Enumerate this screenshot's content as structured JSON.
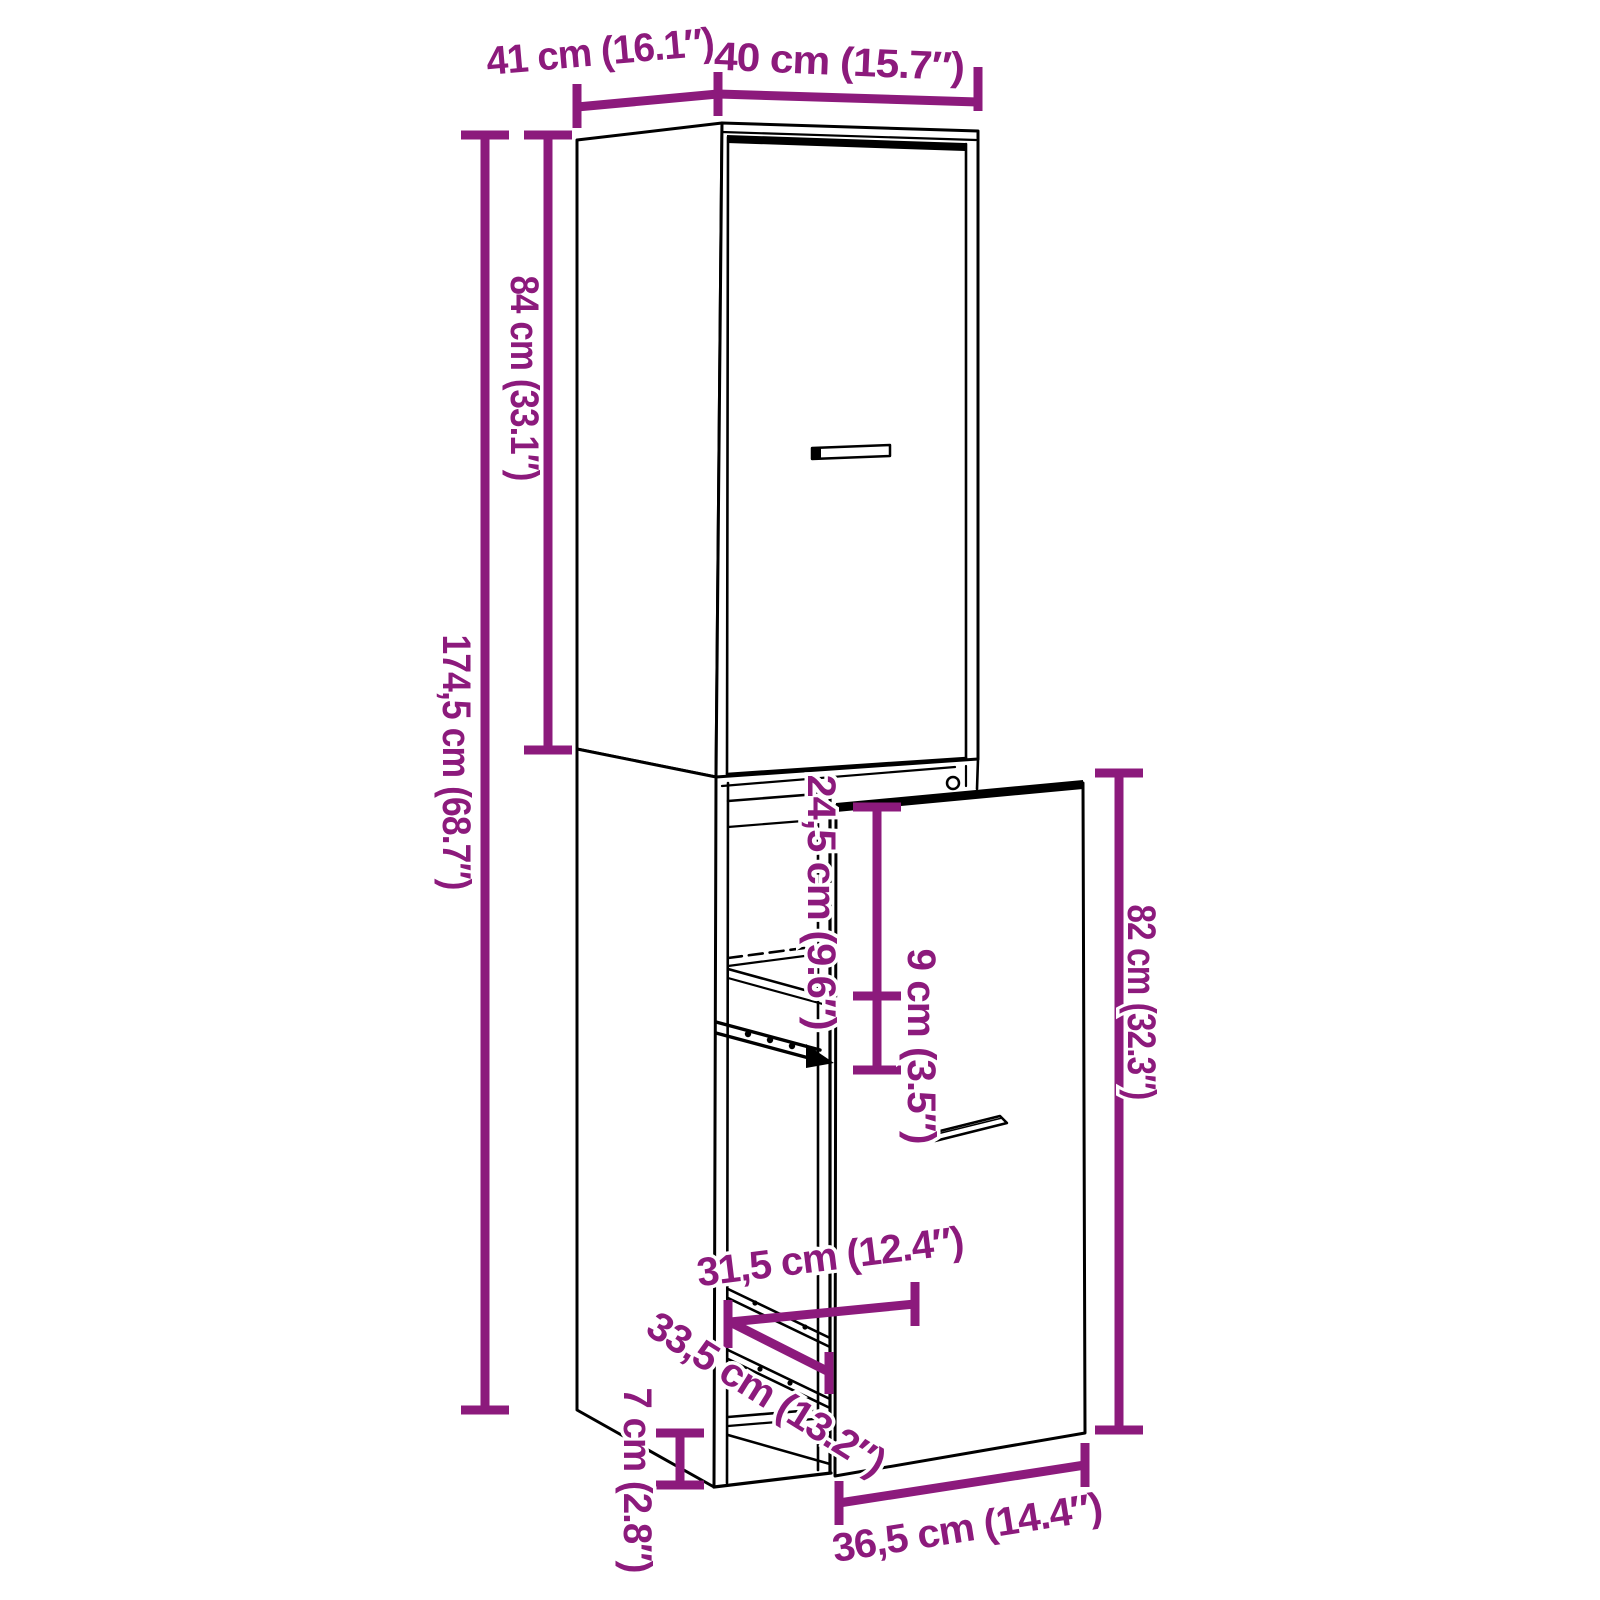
{
  "figure": {
    "type": "furniture-dimension-diagram",
    "subject": "tall narrow cabinet with pull-out drawer unit",
    "background_color": "#ffffff",
    "outline_color": "#000000",
    "dimension_color": "#8c1a7c"
  },
  "labels": {
    "top_depth": "41 cm (16.1″)",
    "top_width": "40 cm (15.7″)",
    "upper_unit_height": "84 cm (33.1″)",
    "total_height": "174,5 cm (68.7″)",
    "drawer_top_section": "24,5 cm (9.6″)",
    "drawer_mid_section": "9 cm (3.5″)",
    "drawer_front_height": "82 cm (32.3″)",
    "inner_width": "31,5 cm (12.4″)",
    "inner_depth": "33,5 cm (13.2″)",
    "plinth_height": "7 cm (2.8″)",
    "drawer_extension_depth": "36,5 cm (14.4″)"
  }
}
